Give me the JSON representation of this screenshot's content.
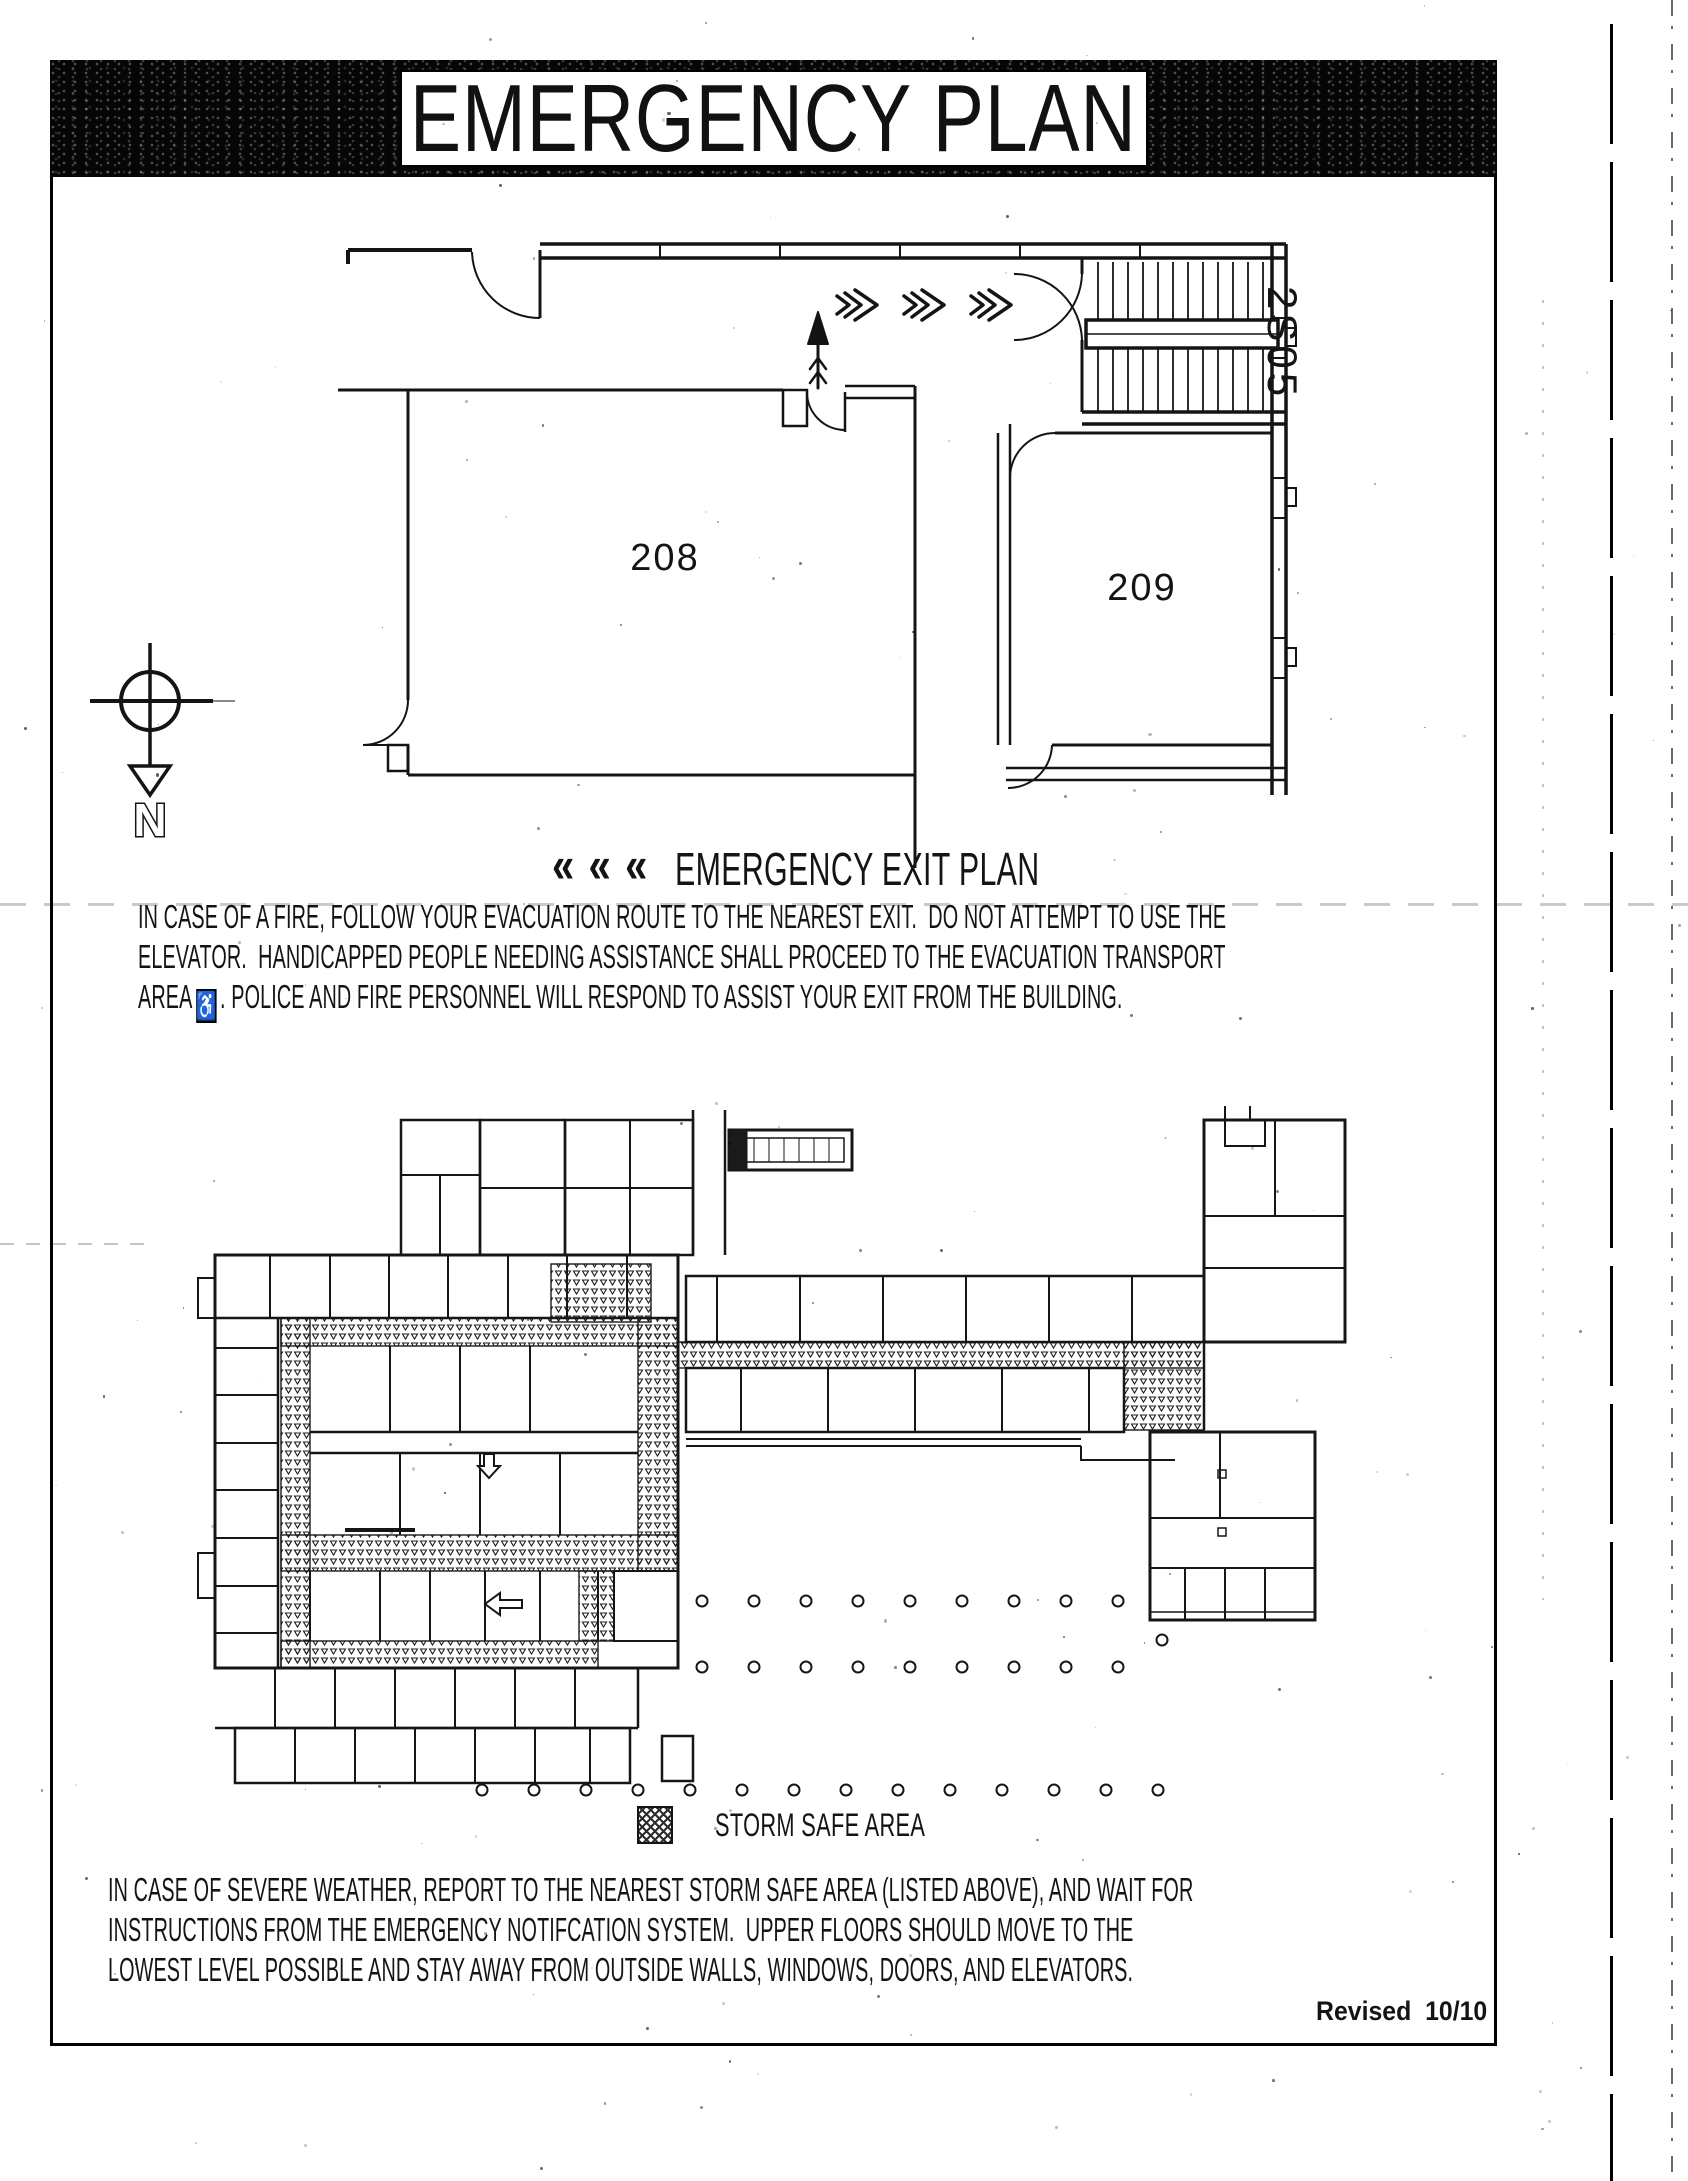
{
  "banner": {
    "title": "EMERGENCY PLAN"
  },
  "exit_section": {
    "chevrons": "« « «",
    "heading": "EMERGENCY EXIT PLAN",
    "plan_labels": {
      "room_a": "208",
      "room_b": "209",
      "stairwell": "2S05",
      "compass": "N"
    },
    "notice": {
      "line1": "IN CASE OF A FIRE, FOLLOW YOUR EVACUATION ROUTE TO THE NEAREST EXIT.  DO NOT ATTEMPT TO USE THE",
      "line2": "ELEVATOR.  HANDICAPPED PEOPLE NEEDING ASSISTANCE SHALL PROCEED TO THE EVACUATION TRANSPORT",
      "line3_prefix": "AREA",
      "wheelchair_icon": "♿",
      "line3_suffix": ". POLICE AND FIRE PERSONNEL WILL RESPOND TO ASSIST YOUR EXIT FROM THE BUILDING."
    }
  },
  "storm_section": {
    "legend_label": "STORM SAFE AREA",
    "notice": {
      "line1": "IN CASE OF SEVERE WEATHER, REPORT TO THE NEAREST STORM SAFE AREA (LISTED ABOVE), AND WAIT FOR",
      "line2": "INSTRUCTIONS FROM THE EMERGENCY NOTIFCATION SYSTEM.  UPPER FLOORS SHOULD MOVE TO THE",
      "line3": "LOWEST LEVEL POSSIBLE AND STAY AWAY FROM OUTSIDE WALLS, WINDOWS, DOORS, AND ELEVATORS."
    }
  },
  "footer": {
    "revised": "Revised  10/10"
  },
  "colors": {
    "ink": "#141414",
    "paper": "#ffffff",
    "banner_black": "#060606"
  }
}
